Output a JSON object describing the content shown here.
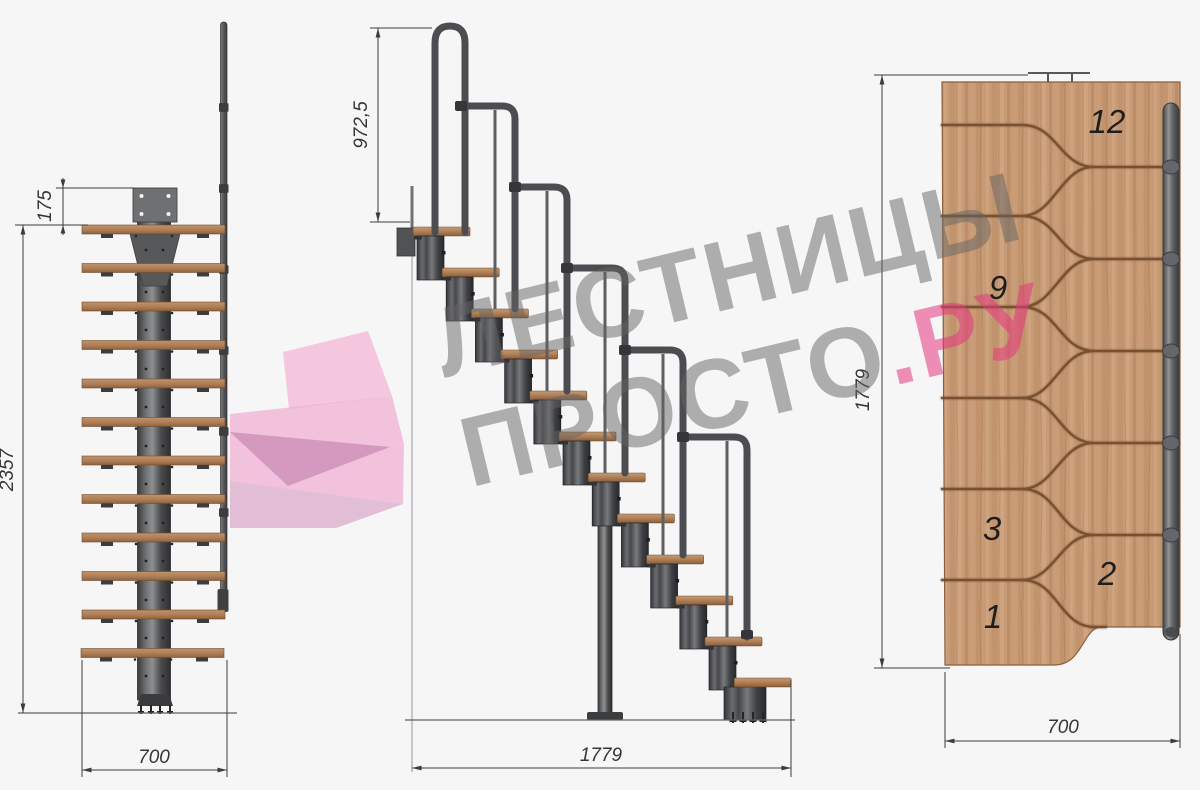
{
  "page": {
    "background": "#f6f6f7",
    "description": "Technical drawing of a modular staircase: front elevation, side elevation and top plan view"
  },
  "watermark": {
    "line1": "ЛЕСТНИЦЫ",
    "line2_gray": "ПРОСТО",
    "line2_pink": ".РУ",
    "gray_color": "#9c9c9c",
    "pink_color": "#ec6f9f"
  },
  "front_view": {
    "name": "front elevation",
    "step_count": 12,
    "dims": {
      "top_offset": "175",
      "total_height": "2357",
      "width": "700"
    }
  },
  "side_view": {
    "name": "side elevation",
    "step_count": 12,
    "handrail_hoops": 6,
    "dims": {
      "handrail_height": "972,5",
      "total_length": "1779"
    }
  },
  "plan_view": {
    "name": "top plan",
    "step_count": 12,
    "step_labels": [
      "12",
      "9",
      "3",
      "2",
      "1"
    ],
    "dims": {
      "total_length": "1779",
      "tread_width": "700"
    }
  },
  "materials": {
    "wood": "#c89b77",
    "wood_groove": "#744e2e",
    "metal_dark": "#45464a",
    "metal_mid": "#6d6f71",
    "dimension_color": "#353535"
  }
}
